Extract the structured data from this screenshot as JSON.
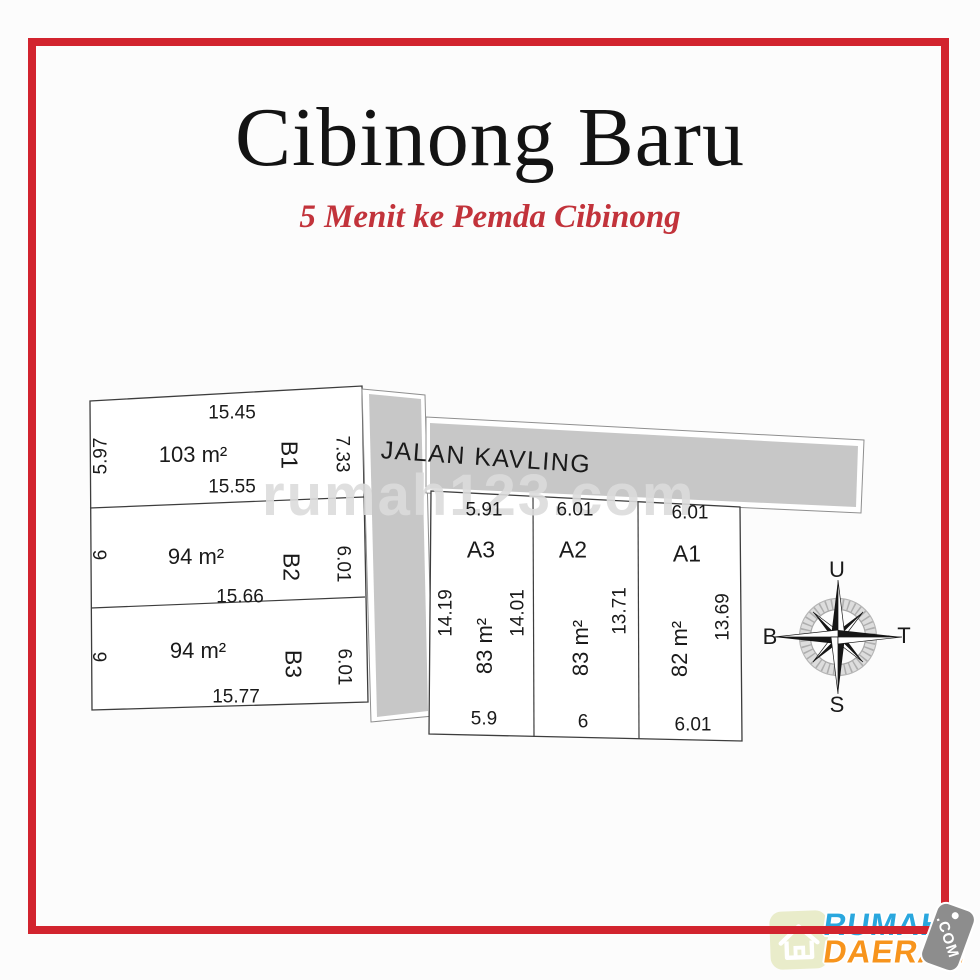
{
  "header": {
    "title": "Cibinong Baru",
    "subtitle": "5 Menit ke Pemda Cibinong"
  },
  "watermark": "rumah123.com",
  "road": {
    "label": "JALAN KAVLING"
  },
  "plots_b": [
    {
      "id": "B1",
      "area": "103 m²",
      "top": "15.45",
      "bottom": "15.55",
      "left": "5.97",
      "right": "7.33"
    },
    {
      "id": "B2",
      "area": "94 m²",
      "bottom": "15.66",
      "left": "6",
      "right": "6.01"
    },
    {
      "id": "B3",
      "area": "94 m²",
      "bottom": "15.77",
      "left": "6",
      "right": "6.01"
    }
  ],
  "plots_a": [
    {
      "id": "A3",
      "area": "83 m²",
      "top": "5.91",
      "bottom": "5.9",
      "left": "14.19",
      "right": "14.01"
    },
    {
      "id": "A2",
      "area": "83 m²",
      "top": "6.01",
      "bottom": "6",
      "right": "13.71"
    },
    {
      "id": "A1",
      "area": "82 m²",
      "top": "6.01",
      "bottom": "6.01",
      "right": "13.69"
    }
  ],
  "compass": {
    "north": "U",
    "east": "T",
    "south": "S",
    "west": "B"
  },
  "logo": {
    "name_top": "RUMAH",
    "name_bottom": "DAERAH",
    "tag": ".COM"
  },
  "colors": {
    "frame_red": "#d2242e",
    "subtitle_red": "#c2333b",
    "road_gray": "#c7c7c7",
    "watermark_gray": "#dcdcdc",
    "logo_blue": "#2aa7de",
    "logo_orange": "#f7941d",
    "tag_gray": "#8d8d8d",
    "house_bg": "#e9ecca"
  }
}
